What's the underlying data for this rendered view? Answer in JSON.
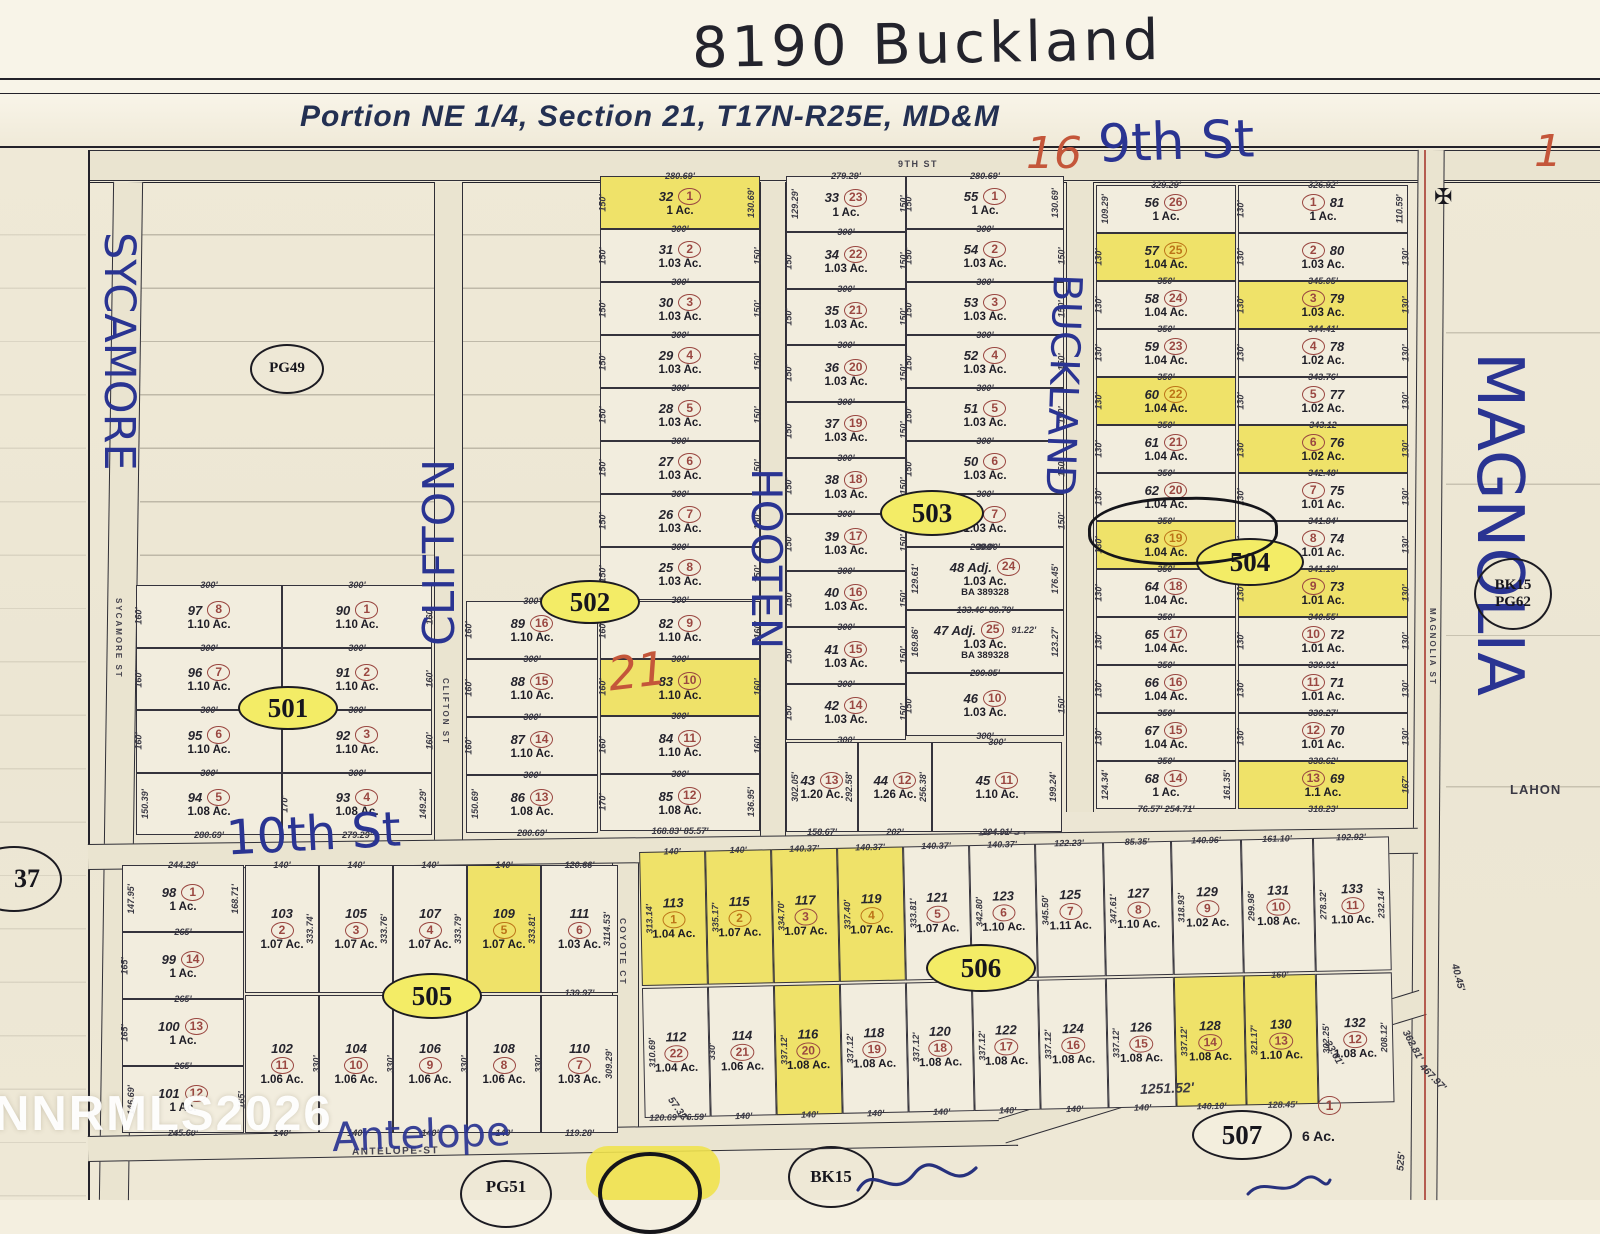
{
  "handwritten": {
    "address": "8190 Buckland",
    "ninth": "9th St",
    "n16": "16",
    "n1": "1",
    "n21": "21",
    "tenth": "10th St",
    "antelope": "Antelope",
    "sycamore": "SYCAMORE",
    "clifton": "CLIFTON",
    "hooten": "HOOTEN",
    "buckland": "BUCKLAND",
    "magnolia": "MAGNOLIA"
  },
  "title": "Portion  NE 1/4,  Section 21,  T17N-R25E,  MD&M",
  "watermark": "NNRMLS2026",
  "street_print": {
    "ninth": "9TH ST",
    "tenth": "10TH-ST",
    "antelope": "ANTELOPE-ST",
    "coyote": "COYOTE CT",
    "clifton": "CLIFTON ST",
    "sycamore": "SYCAMORE ST",
    "magnolia": "MAGNOLIA ST"
  },
  "ovals": {
    "o501": "501",
    "o502": "502",
    "o503": "503",
    "o504": "504",
    "o505": "505",
    "o506": "506",
    "o507": "507"
  },
  "refs": {
    "pg49": "PG49",
    "bk15a": "BK15",
    "pg62": "PG62",
    "n37": "37",
    "bk15b": "BK15",
    "pg51": "PG51",
    "lahon": "LAHON"
  },
  "block507": {
    "n": "1",
    "ac": "6 Ac.",
    "frontage": "1251.52'"
  },
  "misc_dims": {
    "d125152": "1251.52'",
    "d525": "525'",
    "d46797": "467.97'",
    "d36281": "362.81'",
    "d3361": "33.61'",
    "d5732": "57.32'",
    "d20812": "208.12'",
    "d4045": "40.45'"
  },
  "lots": {
    "b32": [
      {
        "a": "32",
        "n": "1",
        "ac": "1 Ac.",
        "t": "280.69'",
        "l": "150'",
        "r": "130.69'",
        "b": "300'",
        "hl": true
      },
      {
        "a": "31",
        "n": "2",
        "ac": "1.03 Ac.",
        "l": "150'",
        "r": "150'",
        "b": "300'"
      },
      {
        "a": "30",
        "n": "3",
        "ac": "1.03 Ac.",
        "l": "150'",
        "r": "150'",
        "b": "300'"
      },
      {
        "a": "29",
        "n": "4",
        "ac": "1.03 Ac.",
        "l": "150'",
        "r": "150'",
        "b": "300'"
      },
      {
        "a": "28",
        "n": "5",
        "ac": "1.03 Ac.",
        "l": "150'",
        "r": "150'",
        "b": "300'"
      },
      {
        "a": "27",
        "n": "6",
        "ac": "1.03 Ac.",
        "l": "150'",
        "r": "150'",
        "b": "300'"
      },
      {
        "a": "26",
        "n": "7",
        "ac": "1.03 Ac.",
        "l": "150'",
        "r": "150'",
        "b": "300'"
      },
      {
        "a": "25",
        "n": "8",
        "ac": "1.03 Ac.",
        "l": "150'",
        "r": "150'",
        "b": "300'"
      }
    ],
    "b82": [
      {
        "a": "82",
        "n": "9",
        "ac": "1.10 Ac.",
        "l": "160'",
        "r": "160'",
        "b": "300'"
      },
      {
        "a": "83",
        "n": "10",
        "ac": "1.10 Ac.",
        "l": "160'",
        "r": "160'",
        "b": "300'",
        "hl": true
      },
      {
        "a": "84",
        "n": "11",
        "ac": "1.10 Ac.",
        "l": "160'",
        "r": "160'",
        "b": "300'"
      },
      {
        "a": "85",
        "n": "12",
        "ac": "1.08 Ac.",
        "l": "170'",
        "r": "136.95'",
        "b": "168.83'  85.57'"
      }
    ],
    "c33": [
      {
        "a": "33",
        "n": "23",
        "ac": "1 Ac.",
        "t": "279.29'",
        "l": "129.29'",
        "r": "150'",
        "b": "300'"
      },
      {
        "a": "34",
        "n": "22",
        "ac": "1.03 Ac.",
        "l": "150'",
        "r": "150'",
        "b": "300'"
      },
      {
        "a": "35",
        "n": "21",
        "ac": "1.03 Ac.",
        "l": "150'",
        "r": "150'",
        "b": "300'"
      },
      {
        "a": "36",
        "n": "20",
        "ac": "1.03 Ac.",
        "l": "150'",
        "r": "150'",
        "b": "300'"
      },
      {
        "a": "37",
        "n": "19",
        "ac": "1.03 Ac.",
        "l": "150'",
        "r": "150'",
        "b": "300'"
      },
      {
        "a": "38",
        "n": "18",
        "ac": "1.03 Ac.",
        "l": "150'",
        "r": "150'",
        "b": "300'"
      },
      {
        "a": "39",
        "n": "17",
        "ac": "1.03 Ac.",
        "l": "150'",
        "r": "150'",
        "b": "300'"
      },
      {
        "a": "40",
        "n": "16",
        "ac": "1.03 Ac.",
        "l": "150'",
        "r": "150'",
        "b": "300'"
      },
      {
        "a": "41",
        "n": "15",
        "ac": "1.03 Ac.",
        "l": "150'",
        "r": "150'",
        "b": "300'"
      },
      {
        "a": "42",
        "n": "14",
        "ac": "1.03 Ac.",
        "l": "150'",
        "r": "150'",
        "b": "300'"
      }
    ],
    "r43": [
      {
        "a": "43",
        "n": "13",
        "ac": "1.20 Ac.",
        "l": "302.05'",
        "r": "292.58'",
        "b": "158.67'"
      },
      {
        "a": "44",
        "n": "12",
        "ac": "1.26 Ac.",
        "r": "256.38'",
        "b": "202'"
      },
      {
        "a": "45",
        "n": "11",
        "ac": "1.10 Ac.",
        "t": "300'",
        "r": "199.24'",
        "b": "204.91'"
      }
    ],
    "d55": [
      {
        "a": "55",
        "n": "1",
        "ac": "1 Ac.",
        "t": "280.69'",
        "l": "150'",
        "r": "130.69'",
        "b": "300'"
      },
      {
        "a": "54",
        "n": "2",
        "ac": "1.03 Ac.",
        "l": "150'",
        "r": "150'",
        "b": "300'"
      },
      {
        "a": "53",
        "n": "3",
        "ac": "1.03 Ac.",
        "l": "150'",
        "r": "150'",
        "b": "300'"
      },
      {
        "a": "52",
        "n": "4",
        "ac": "1.03 Ac.",
        "l": "150'",
        "r": "150'",
        "b": "300'"
      },
      {
        "a": "51",
        "n": "5",
        "ac": "1.03 Ac.",
        "l": "150'",
        "r": "150'",
        "b": "300'"
      },
      {
        "a": "50",
        "n": "6",
        "ac": "1.03 Ac.",
        "l": "150'",
        "r": "150'",
        "b": "300'"
      },
      {
        "a": "49",
        "n": "7",
        "ac": "1.03 Ac.",
        "l": "150'",
        "r": "150'",
        "b": "300'"
      }
    ],
    "d48": [
      {
        "name": "48 Adj.",
        "a": "48",
        "n": "24",
        "ac": "1.03 Ac.",
        "t": "299.90'",
        "l": "129.61'",
        "r": "176.45'",
        "x": [
          "BA 389328"
        ]
      },
      {
        "name": "47 Adj.",
        "a": "47",
        "n": "25",
        "ac": "1.03 Ac.",
        "t": "133.46'   89.79'",
        "tail": "91.22'",
        "l": "169.86'",
        "r": "123.27'",
        "b": "299.85'",
        "x": [
          "BA 389328"
        ]
      },
      {
        "a": "46",
        "n": "10",
        "ac": "1.03 Ac.",
        "l": "150'",
        "r": "150'",
        "b": "300'"
      }
    ],
    "e56": [
      {
        "a": "56",
        "n": "26",
        "ac": "1 Ac.",
        "t": "329.29'",
        "l": "109.29'"
      },
      {
        "a": "57",
        "n": "25",
        "ac": "1.04 Ac.",
        "l": "130'",
        "b": "350'",
        "hl": true,
        "o": true
      },
      {
        "a": "58",
        "n": "24",
        "ac": "1.04 Ac.",
        "l": "130'",
        "b": "350'"
      },
      {
        "a": "59",
        "n": "23",
        "ac": "1.04 Ac.",
        "l": "130'",
        "b": "350'"
      },
      {
        "a": "60",
        "n": "22",
        "ac": "1.04 Ac.",
        "l": "130'",
        "b": "350'",
        "hl": true,
        "o": true
      },
      {
        "a": "61",
        "n": "21",
        "ac": "1.04 Ac.",
        "l": "130'",
        "b": "350'"
      },
      {
        "a": "62",
        "n": "20",
        "ac": "1.04 Ac.",
        "l": "130'",
        "b": "350'"
      },
      {
        "a": "63",
        "n": "19",
        "ac": "1.04 Ac.",
        "l": "130'",
        "b": "350'",
        "hl": true,
        "o": true
      },
      {
        "a": "64",
        "n": "18",
        "ac": "1.04 Ac.",
        "l": "130'",
        "b": "350'"
      },
      {
        "a": "65",
        "n": "17",
        "ac": "1.04 Ac.",
        "l": "130'",
        "b": "350'"
      },
      {
        "a": "66",
        "n": "16",
        "ac": "1.04 Ac.",
        "l": "130'",
        "b": "350'"
      },
      {
        "a": "67",
        "n": "15",
        "ac": "1.04 Ac.",
        "l": "130'",
        "b": "350'"
      },
      {
        "a": "68",
        "n": "14",
        "ac": "1 Ac.",
        "l": "124.34'",
        "r": "161.35'",
        "b": "76.57'   254.71'"
      }
    ],
    "f81": [
      {
        "a": "81",
        "n": "1",
        "ac": "1 Ac.",
        "t": "326.92'",
        "l": "130'",
        "r": "110.59'"
      },
      {
        "a": "80",
        "n": "2",
        "ac": "1.03 Ac.",
        "l": "130'",
        "r": "130'",
        "b": "345.05'"
      },
      {
        "a": "79",
        "n": "3",
        "ac": "1.03 Ac.",
        "l": "130'",
        "r": "130'",
        "b": "344.41'",
        "hl": true
      },
      {
        "a": "78",
        "n": "4",
        "ac": "1.02 Ac.",
        "l": "130'",
        "r": "130'",
        "b": "343.76'"
      },
      {
        "a": "77",
        "n": "5",
        "ac": "1.02 Ac.",
        "l": "130'",
        "r": "130'",
        "b": "343.12"
      },
      {
        "a": "76",
        "n": "6",
        "ac": "1.02 Ac.",
        "l": "130'",
        "r": "130'",
        "b": "342.48'",
        "hl": true
      },
      {
        "a": "75",
        "n": "7",
        "ac": "1.01 Ac.",
        "l": "130'",
        "r": "130'",
        "b": "341.84'"
      },
      {
        "a": "74",
        "n": "8",
        "ac": "1.01 Ac.",
        "l": "130'",
        "r": "130'",
        "b": "341.19'"
      },
      {
        "a": "73",
        "n": "9",
        "ac": "1.01 Ac.",
        "l": "130'",
        "r": "130'",
        "b": "340.55'",
        "hl": true
      },
      {
        "a": "72",
        "n": "10",
        "ac": "1.01 Ac.",
        "l": "130'",
        "r": "130'",
        "b": "339.91'"
      },
      {
        "a": "71",
        "n": "11",
        "ac": "1.01 Ac.",
        "l": "130'",
        "r": "130'",
        "b": "339.27'"
      },
      {
        "a": "70",
        "n": "12",
        "ac": "1.01 Ac.",
        "l": "130'",
        "r": "130'",
        "b": "338.62'"
      },
      {
        "a": "69",
        "n": "13",
        "ac": "1.1 Ac.",
        "r": "167'",
        "b": "318.23'",
        "hl": true
      }
    ],
    "q501a": [
      {
        "a": "97",
        "n": "8",
        "ac": "1.10 Ac.",
        "t": "300'",
        "l": "160'",
        "b": "300'"
      },
      {
        "a": "96",
        "n": "7",
        "ac": "1.10 Ac.",
        "l": "160'",
        "b": "300'"
      },
      {
        "a": "95",
        "n": "6",
        "ac": "1.10 Ac.",
        "l": "160'",
        "b": "300'"
      },
      {
        "a": "94",
        "n": "5",
        "ac": "1.08 Ac.",
        "l": "150.39'",
        "b": "280.69'"
      }
    ],
    "q501b": [
      {
        "a": "90",
        "n": "1",
        "ac": "1.10 Ac.",
        "t": "300'",
        "r": "160'",
        "b": "300'"
      },
      {
        "a": "91",
        "n": "2",
        "ac": "1.10 Ac.",
        "r": "160'",
        "b": "300'"
      },
      {
        "a": "92",
        "n": "3",
        "ac": "1.10 Ac.",
        "r": "160'",
        "b": "300'"
      },
      {
        "a": "93",
        "n": "4",
        "ac": "1.08 Ac.",
        "l": "170'",
        "r": "149.29'",
        "b": "279.29'"
      }
    ],
    "q502": [
      {
        "a": "89",
        "n": "16",
        "ac": "1.10 Ac.",
        "t": "300'",
        "l": "160'",
        "b": "300'"
      },
      {
        "a": "88",
        "n": "15",
        "ac": "1.10 Ac.",
        "l": "160'",
        "b": "300'"
      },
      {
        "a": "87",
        "n": "14",
        "ac": "1.10 Ac.",
        "l": "160'",
        "b": "300'"
      },
      {
        "a": "86",
        "n": "13",
        "ac": "1.08 Ac.",
        "l": "150.69'",
        "b": "280.69'"
      }
    ],
    "p505L": [
      {
        "a": "98",
        "n": "1",
        "ac": "1 Ac.",
        "t": "244.29'",
        "l": "147.95'",
        "r": "168.71'",
        "b": "265'"
      },
      {
        "a": "99",
        "n": "14",
        "ac": "1 Ac.",
        "l": "165'",
        "b": "265'"
      },
      {
        "a": "100",
        "n": "13",
        "ac": "1 Ac.",
        "l": "165'",
        "b": "265'"
      },
      {
        "a": "101",
        "n": "12",
        "ac": "1 Ac.",
        "l": "146.69'",
        "r": "165'",
        "b": "245.60'"
      }
    ],
    "p505t": [
      {
        "a": "103",
        "n": "2",
        "ac": "1.07 Ac.",
        "t": "140'",
        "r": "333.74'"
      },
      {
        "a": "105",
        "n": "3",
        "ac": "1.07 Ac.",
        "t": "140'",
        "r": "333.76'"
      },
      {
        "a": "107",
        "n": "4",
        "ac": "1.07 Ac.",
        "t": "140'",
        "r": "333.79'"
      },
      {
        "a": "109",
        "n": "5",
        "ac": "1.07 Ac.",
        "t": "140'",
        "r": "333.81'",
        "hl": true,
        "o": true
      },
      {
        "a": "111",
        "n": "6",
        "ac": "1.03 Ac.",
        "t": "120.66'",
        "r": "3114.53'",
        "b": "139.97'"
      }
    ],
    "p505b": [
      {
        "a": "102",
        "n": "11",
        "ac": "1.06 Ac.",
        "r": "330'",
        "b": "140'"
      },
      {
        "a": "104",
        "n": "10",
        "ac": "1.06 Ac.",
        "r": "330'",
        "b": "140'"
      },
      {
        "a": "106",
        "n": "9",
        "ac": "1.06 Ac.",
        "r": "330'",
        "b": "140'"
      },
      {
        "a": "108",
        "n": "8",
        "ac": "1.06 Ac.",
        "r": "330'",
        "b": "140'"
      },
      {
        "a": "110",
        "n": "7",
        "ac": "1.03 Ac.",
        "r": "309.29'",
        "b": "119.28'"
      }
    ],
    "p506t": [
      {
        "a": "113",
        "n": "1",
        "ac": "1.04 Ac.",
        "t": "140'",
        "l": "313.14'",
        "hl": true,
        "o": true
      },
      {
        "a": "115",
        "n": "2",
        "ac": "1.07 Ac.",
        "t": "140'",
        "l": "335.17'",
        "hl": true,
        "o": true
      },
      {
        "a": "117",
        "n": "3",
        "ac": "1.07 Ac.",
        "t": "140.37'",
        "l": "334.70'",
        "hl": true
      },
      {
        "a": "119",
        "n": "4",
        "ac": "1.07 Ac.",
        "t": "140.37'",
        "l": "337.40'",
        "hl": true,
        "o": true
      },
      {
        "a": "121",
        "n": "5",
        "ac": "1.07 Ac.",
        "t": "140.37'",
        "l": "333.81'"
      },
      {
        "a": "123",
        "n": "6",
        "ac": "1.10 Ac.",
        "t": "140.37'",
        "l": "342.80'"
      },
      {
        "a": "125",
        "n": "7",
        "ac": "1.11 Ac.",
        "t": "122.23'",
        "l": "345.50'"
      },
      {
        "a": "127",
        "n": "8",
        "ac": "1.10 Ac.",
        "t": "85.35'",
        "l": "347.61'"
      },
      {
        "a": "129",
        "n": "9",
        "ac": "1.02 Ac.",
        "t": "140.96'",
        "l": "318.93'"
      },
      {
        "a": "131",
        "n": "10",
        "ac": "1.08 Ac.",
        "t": "161.10'",
        "l": "299.98'"
      },
      {
        "a": "133",
        "n": "11",
        "ac": "1.10 Ac.",
        "t": "192.92'",
        "l": "278.32'",
        "r": "232.14'"
      }
    ],
    "p506b": [
      {
        "a": "112",
        "n": "22",
        "ac": "1.04 Ac.",
        "l": "310.69'",
        "b": "120.69'  76.59'"
      },
      {
        "a": "114",
        "n": "21",
        "ac": "1.06 Ac.",
        "l": "330'",
        "b": "140'"
      },
      {
        "a": "116",
        "n": "20",
        "ac": "1.08 Ac.",
        "l": "337.12'",
        "b": "140'",
        "hl": true
      },
      {
        "a": "118",
        "n": "19",
        "ac": "1.08 Ac.",
        "l": "337.12'",
        "b": "140'"
      },
      {
        "a": "120",
        "n": "18",
        "ac": "1.08 Ac.",
        "l": "337.12'",
        "b": "140'"
      },
      {
        "a": "122",
        "n": "17",
        "ac": "1.08 Ac.",
        "l": "337.12'",
        "b": "140'"
      },
      {
        "a": "124",
        "n": "16",
        "ac": "1.08 Ac.",
        "l": "337.12'",
        "b": "140'"
      },
      {
        "a": "126",
        "n": "15",
        "ac": "1.08 Ac.",
        "l": "337.12'",
        "b": "140'"
      },
      {
        "a": "128",
        "n": "14",
        "ac": "1.08 Ac.",
        "l": "337.12'",
        "b": "140.10'",
        "hl": true
      },
      {
        "a": "130",
        "n": "13",
        "ac": "1.10 Ac.",
        "t": "160'",
        "l": "321.17'",
        "b": "128.45'",
        "hl": true
      },
      {
        "a": "132",
        "n": "12",
        "ac": "1.08 Ac.",
        "l": "302.25'",
        "r": "208.12'"
      }
    ]
  }
}
